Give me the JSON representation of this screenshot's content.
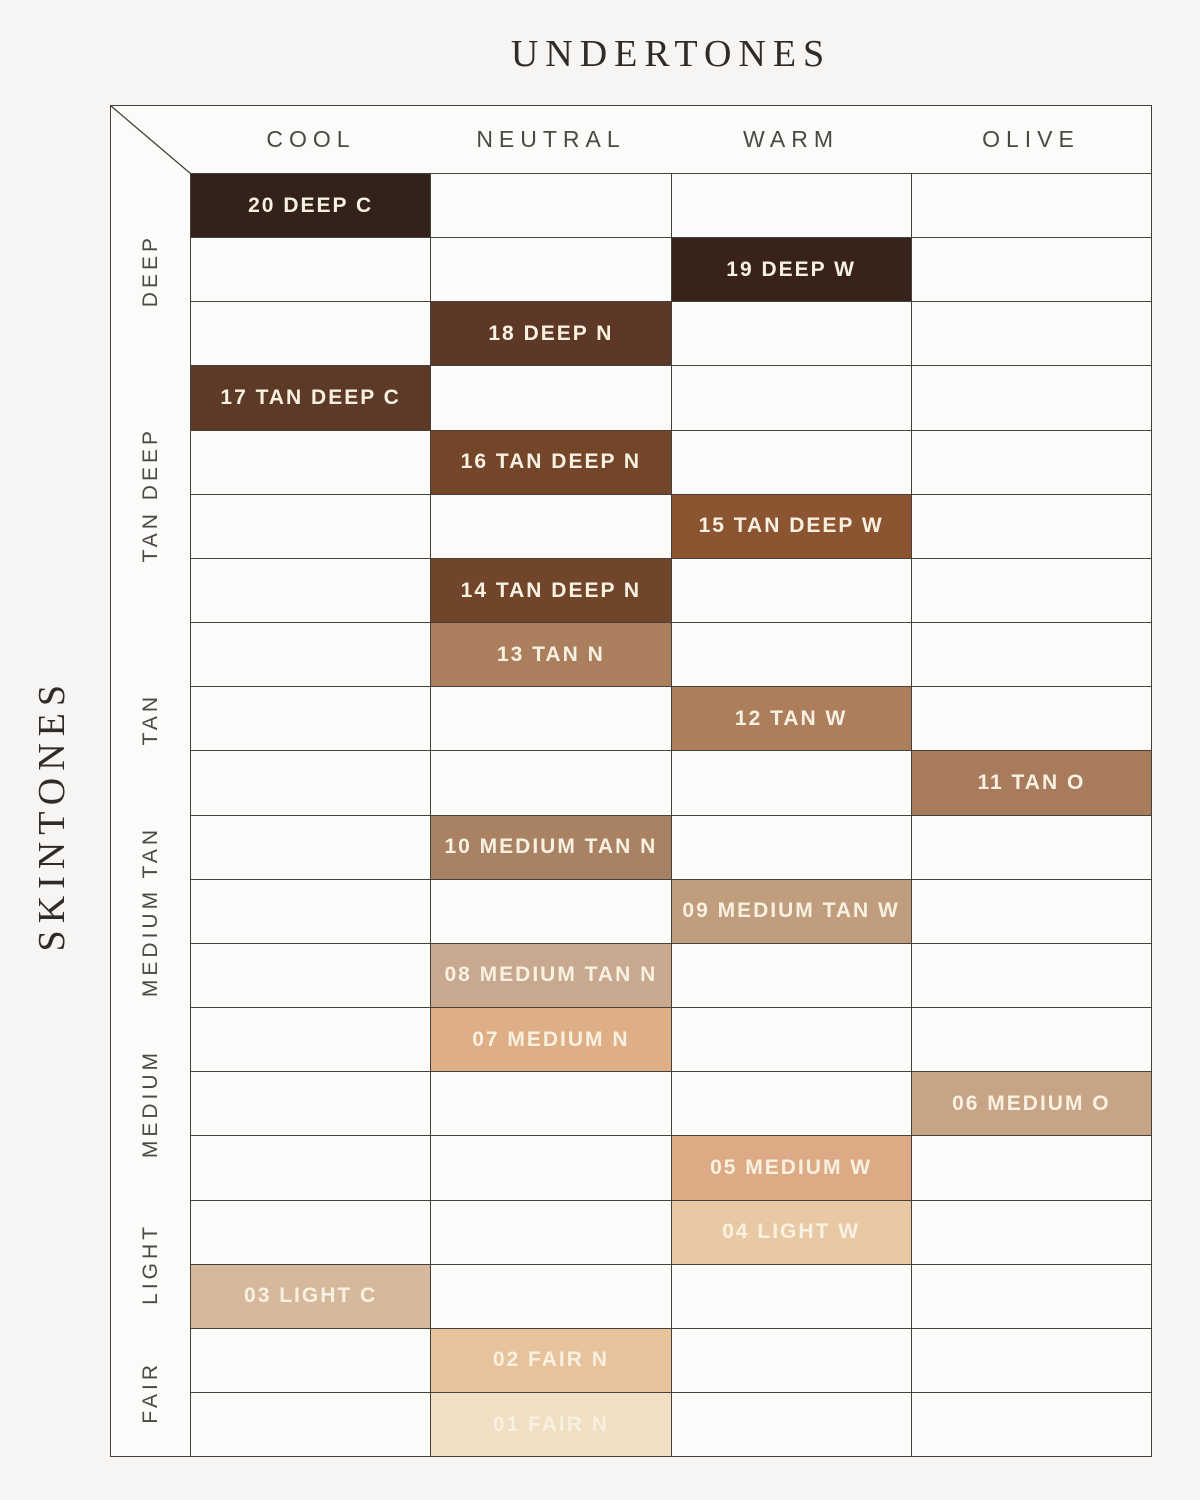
{
  "title": "UNDERTONES",
  "side_label": "SKINTONES",
  "colors": {
    "page_background": "#F6F5F3",
    "cell_background": "#FBFBF9",
    "grid_line": "#45403C",
    "header_text": "#4C4845",
    "title_text": "#2F2B28",
    "shade_label_text": "#F8F1E2"
  },
  "chart_data": {
    "type": "table",
    "title": "UNDERTONES",
    "row_axis_label": "SKINTONES",
    "columns": [
      "COOL",
      "NEUTRAL",
      "WARM",
      "OLIVE"
    ],
    "row_groups": [
      {
        "label": "DEEP",
        "row_count": 3
      },
      {
        "label": "TAN DEEP",
        "row_count": 4
      },
      {
        "label": "TAN",
        "row_count": 3
      },
      {
        "label": "MEDIUM TAN",
        "row_count": 3
      },
      {
        "label": "MEDIUM",
        "row_count": 3
      },
      {
        "label": "LIGHT",
        "row_count": 2
      },
      {
        "label": "FAIR",
        "row_count": 2
      }
    ],
    "rows": [
      {
        "shade": "20 DEEP C",
        "undertone": "COOL",
        "skintone": "DEEP",
        "color": "#33221A"
      },
      {
        "shade": "19 DEEP W",
        "undertone": "WARM",
        "skintone": "DEEP",
        "color": "#38231A"
      },
      {
        "shade": "18 DEEP N",
        "undertone": "NEUTRAL",
        "skintone": "DEEP",
        "color": "#5E3826"
      },
      {
        "shade": "17 TAN DEEP C",
        "undertone": "COOL",
        "skintone": "TAN DEEP",
        "color": "#5C3A27"
      },
      {
        "shade": "16 TAN DEEP N",
        "undertone": "NEUTRAL",
        "skintone": "TAN DEEP",
        "color": "#73462A"
      },
      {
        "shade": "15 TAN DEEP W",
        "undertone": "WARM",
        "skintone": "TAN DEEP",
        "color": "#8B5532"
      },
      {
        "shade": "14 TAN DEEP N",
        "undertone": "NEUTRAL",
        "skintone": "TAN DEEP",
        "color": "#71452A"
      },
      {
        "shade": "13 TAN N",
        "undertone": "NEUTRAL",
        "skintone": "TAN",
        "color": "#AB7F5D"
      },
      {
        "shade": "12 TAN W",
        "undertone": "WARM",
        "skintone": "TAN",
        "color": "#AC7E5B"
      },
      {
        "shade": "11 TAN O",
        "undertone": "OLIVE",
        "skintone": "TAN",
        "color": "#A97B5D"
      },
      {
        "shade": "10 MEDIUM TAN N",
        "undertone": "NEUTRAL",
        "skintone": "MEDIUM TAN",
        "color": "#A98263"
      },
      {
        "shade": "09 MEDIUM TAN W",
        "undertone": "WARM",
        "skintone": "MEDIUM TAN",
        "color": "#C09D7C"
      },
      {
        "shade": "08 MEDIUM TAN N",
        "undertone": "NEUTRAL",
        "skintone": "MEDIUM TAN",
        "color": "#C8A88E"
      },
      {
        "shade": "07 MEDIUM N",
        "undertone": "NEUTRAL",
        "skintone": "MEDIUM",
        "color": "#DEAE87"
      },
      {
        "shade": "06 MEDIUM O",
        "undertone": "OLIVE",
        "skintone": "MEDIUM",
        "color": "#C7A486"
      },
      {
        "shade": "05 MEDIUM W",
        "undertone": "WARM",
        "skintone": "MEDIUM",
        "color": "#DCAB85"
      },
      {
        "shade": "04 LIGHT W",
        "undertone": "WARM",
        "skintone": "LIGHT",
        "color": "#E9C9A3"
      },
      {
        "shade": "03 LIGHT C",
        "undertone": "COOL",
        "skintone": "LIGHT",
        "color": "#D6B99C"
      },
      {
        "shade": "02 FAIR N",
        "undertone": "NEUTRAL",
        "skintone": "FAIR",
        "color": "#E7C39C"
      },
      {
        "shade": "01 FAIR N",
        "undertone": "NEUTRAL",
        "skintone": "FAIR",
        "color": "#F0DFC2"
      }
    ]
  }
}
